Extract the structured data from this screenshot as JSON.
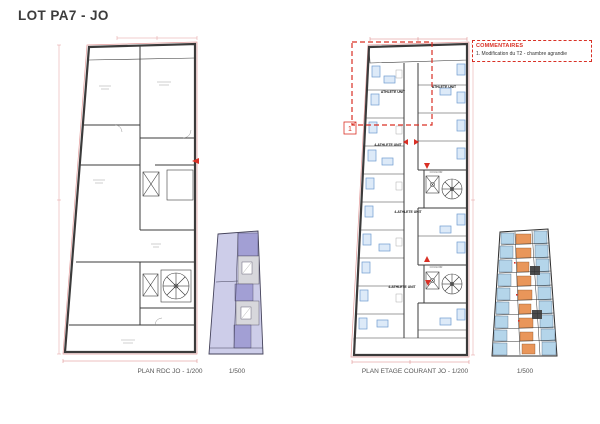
{
  "page": {
    "title": "LOT PA7 - JO"
  },
  "commentaires": {
    "title": "COMMENTAIRES",
    "items": [
      "1. Modification du T2 - chambre agrandie"
    ]
  },
  "plans": {
    "rdc": {
      "caption": "PLAN RDC JO - 1/200",
      "key_caption": "1/500"
    },
    "etage": {
      "caption": "PLAN ETAGE COURANT JO - 1/200",
      "key_caption": "1/500",
      "marker": "1",
      "labels": {
        "unit_a": "ATHLETE UNIT",
        "unit_b": "ATHLETE UNIT",
        "unit_c": "4-ATHLETE UNIT",
        "unit_d": "4-ATHLETE UNIT",
        "unit_e": "4-ATHLETE UNIT",
        "corridor_top": "COULOIR",
        "corridor_bottom": "COULOIR"
      }
    }
  },
  "colors": {
    "annotation_red": "#d93025",
    "boundary_pink": "#e29a9a",
    "wall_dark": "#3b3b3b",
    "key_lavender": "#cdcde9",
    "key_purple": "#a29fd4",
    "key_gray": "#d7d7dc",
    "key_orange": "#e9965a",
    "key_blue": "#b4d5ea",
    "bed_blue": "#6f9cd1",
    "bed_fill": "#ddeaf8"
  }
}
